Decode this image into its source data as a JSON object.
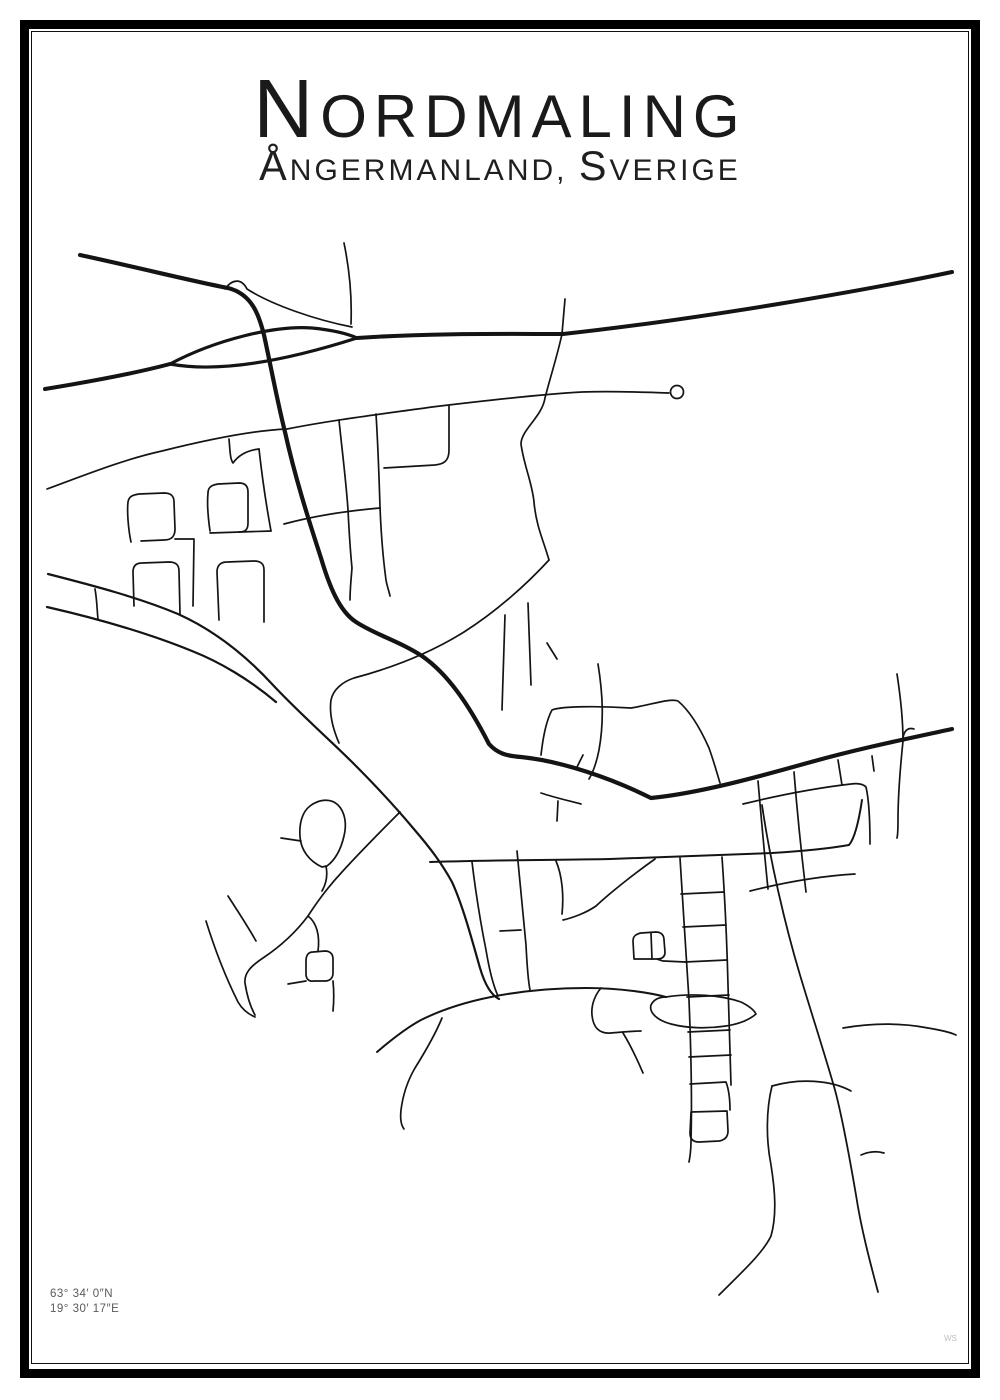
{
  "poster": {
    "title": "Nordmaling",
    "subtitle": "Ångermanland, Sverige",
    "coordinates": {
      "line1": "63° 34′ 0″N",
      "line2": "19° 30′ 17″E"
    },
    "watermark": "WS",
    "colors": {
      "road": "#141414",
      "frame": "#000000",
      "coord_text": "#5a5a5a"
    }
  },
  "map": {
    "viewBox": "0 0 1000 1400",
    "default_width": 1.7,
    "roads": [
      {
        "d": "M 45 389 C 100 380 140 372 170 364",
        "w": 4
      },
      {
        "d": "M 170 364 C 215 340 275 325 312 328 C 332 330 346 333 357 338",
        "w": 3.2
      },
      {
        "d": "M 170 364 C 218 373 285 361 357 338",
        "w": 3.2
      },
      {
        "d": "M 357 338 C 430 333 500 334 563 334 C 700 319 862 291 952 272",
        "w": 4
      },
      {
        "d": "M 80 255 C 140 268 196 282 228 288 C 252 294 259 315 264 335 C 271 367 277 400 285 432 C 295 477 308 518 321 558 C 329 585 339 611 356 622 C 376 635 399 641 422 656 C 448 674 469 705 489 744 C 497 753 506 756 521 757 C 561 761 611 778 651 798 C 701 793 761 776 811 762 C 861 748 911 738 952 729",
        "w": 4.2
      },
      {
        "d": "M 225 289 C 233 278 242 279 247 289 C 272 305 316 320 352 327"
      },
      {
        "d": "M 344 243 C 350 272 352 298 351 324"
      },
      {
        "d": "M 565 299 L 562 334"
      },
      {
        "d": "M 562 334 C 557 357 550 378 545 398 C 542 417 521 430 521 444 C 524 466 532 482 534 502 C 536 526 544 542 549 560"
      },
      {
        "d": "M 47 489 C 85 475 125 459 162 451 C 222 436 262 430 287 429 C 332 420 382 414 432 407 C 482 401 542 394 582 392 C 612 391 642 392 669 393"
      },
      {
        "d": "M 339 420 C 342 450 346 480 348 510 C 349 530 350 548 352 568 C 351 580 350 590 350 600"
      },
      {
        "d": "M 376 414 C 378 445 379 475 380 507 C 381 532 383 558 386 580 C 387 586 389 591 390 596"
      },
      {
        "d": "M 449 406 L 449 450 C 449 461 444 464 435 465 L 384 468"
      },
      {
        "d": "M 284 524 C 310 517 345 511 380 508"
      },
      {
        "d": "M 259 449 C 262 476 266 504 271 531"
      },
      {
        "d": "M 229 439 C 230 450 230 459 233 463 C 240 453 250 450 259 449"
      },
      {
        "d": "M 210 533 L 271 531"
      },
      {
        "d": "M 131 542 C 128 528 127 510 128 502 C 129 496 133 495 139 494 L 164 493 C 171 493 174 496 174 502 L 175 529 C 175 537 171 540 164 540 L 141 541"
      },
      {
        "d": "M 175 539 L 194 539 L 193 606"
      },
      {
        "d": "M 210 531 C 208 517 207 503 208 493 C 208 487 212 485 218 484 L 239 483 C 245 483 248 486 248 492 L 248 523 C 248 530 245 532 239 532"
      },
      {
        "d": "M 134 606 L 133 572 C 133 566 136 563 142 563 L 169 562 C 176 562 179 565 179 571 L 180 614"
      },
      {
        "d": "M 219 620 L 217 572 C 217 565 221 562 227 562 L 254 561 C 261 561 264 564 264 570 L 264 622"
      },
      {
        "d": "M 48 574 C 95 586 140 598 178 614 C 218 632 248 658 272 684 C 298 712 330 740 352 762 C 377 787 398 810 413 828 C 432 850 442 864 452 882 C 463 906 472 940 480 968 C 485 985 491 995 499 999",
        "w": 2.2
      },
      {
        "d": "M 47 607 C 95 618 148 633 192 651 C 220 662 250 680 276 702",
        "w": 2.2
      },
      {
        "d": "M 95 589 C 97 600 97 610 98 619"
      },
      {
        "d": "M 400 812 C 382 830 362 850 342 872 C 327 888 317 902 308 916 C 296 932 281 946 263 958 C 251 966 244 973 245 983 C 247 996 250 1006 255 1015"
      },
      {
        "d": "M 228 896 C 237 910 247 925 256 941"
      },
      {
        "d": "M 206 921 C 215 950 226 978 238 1002 C 242 1009 248 1014 255 1017"
      },
      {
        "d": "M 308 916 C 317 923 320 936 318 951"
      },
      {
        "d": "M 313 952 C 308 952 306 956 306 961 L 306 974 C 306 979 309 982 314 981 L 325 981 C 330 981 333 978 333 973 L 333 959 C 333 954 330 951 325 951 L 313 952"
      },
      {
        "d": "M 333 981 C 334 991 334 1001 333 1011"
      },
      {
        "d": "M 306 981 L 288 984"
      },
      {
        "d": "M 322 867 C 309 861 301 850 300 837 C 299 824 302 812 310 806 C 319 799 331 798 338 805 C 345 812 347 824 344 836 C 341 849 335 860 327 866 L 322 867"
      },
      {
        "d": "M 326 866 C 328 876 326 884 322 891"
      },
      {
        "d": "M 281 838 L 301 841"
      },
      {
        "d": "M 549 560 C 527 584 497 611 464 632 C 424 657 384 670 354 678 C 342 682 333 690 331 700 C 329 714 333 729 339 743"
      },
      {
        "d": "M 505 615 C 504 645 503 678 502 710"
      },
      {
        "d": "M 528 603 C 529 630 530 658 531 685"
      },
      {
        "d": "M 547 643 L 557 659"
      },
      {
        "d": "M 541 755 C 543 737 546 721 552 710 C 561 706 601 706 631 708 C 651 705 669 698 678 701 C 691 712 701 730 709 748 C 714 762 717 773 720 783"
      },
      {
        "d": "M 598 664 C 603 695 604 722 599 750 C 596 765 592 774 589 779"
      },
      {
        "d": "M 583 755 L 576 769"
      },
      {
        "d": "M 897 674 C 901 700 903 720 903 741 C 900 770 898 800 898 820 C 898 828 898 834 897 838"
      },
      {
        "d": "M 903 740 C 903 731 908 727 914 729"
      },
      {
        "d": "M 872 756 L 874 771"
      },
      {
        "d": "M 430 862 C 500 860 560 860 610 859 C 670 857 730 855 772 853 C 805 851 832 848 849 845 C 855 838 859 820 862 800",
        "w": 2
      },
      {
        "d": "M 556 861 C 562 875 564 895 562 914"
      },
      {
        "d": "M 655 859 C 638 871 612 891 596 906 C 586 913 572 918 563 920"
      },
      {
        "d": "M 680 858 C 683 905 686 955 689 1000 C 691 1050 692 1105 691 1140 C 691 1150 690 1157 689 1162"
      },
      {
        "d": "M 722 857 C 725 900 727 945 728 985 C 729 1020 730 1055 731 1085"
      },
      {
        "d": "M 681 894 L 724 892"
      },
      {
        "d": "M 683 927 L 726 925"
      },
      {
        "d": "M 685 962 L 727 960"
      },
      {
        "d": "M 687 997 L 729 995"
      },
      {
        "d": "M 688 1032 L 730 1030"
      },
      {
        "d": "M 689 1057 L 731 1055"
      },
      {
        "d": "M 690 1084 L 726 1082 C 729 1090 730 1100 730 1110"
      },
      {
        "d": "M 691 1112 L 727 1111 L 728 1131 C 728 1137 725 1140 719 1141 L 699 1142 C 693 1142 690 1139 690 1133 L 691 1112"
      },
      {
        "d": "M 762 805 C 770 860 785 925 800 975 C 812 1015 825 1055 835 1090 C 843 1120 850 1160 856 1195 C 861 1228 870 1262 878 1292",
        "w": 1.8
      },
      {
        "d": "M 861 1155 C 870 1151 877 1151 884 1153"
      },
      {
        "d": "M 772 1086 C 766 1110 766 1140 771 1165 C 775 1190 777 1215 771 1236 C 763 1253 741 1273 719 1295"
      },
      {
        "d": "M 772 1086 C 800 1078 831 1080 851 1091"
      },
      {
        "d": "M 843 1028 C 872 1023 902 1023 928 1028 C 940 1030 950 1032 956 1035"
      },
      {
        "d": "M 758 781 C 761 815 764 850 768 889"
      },
      {
        "d": "M 794 772 C 797 810 801 850 806 892"
      },
      {
        "d": "M 838 760 L 842 785"
      },
      {
        "d": "M 743 804 C 780 795 816 788 851 784 C 858 783 863 784 866 787 C 869 800 870 824 870 844"
      },
      {
        "d": "M 750 891 C 786 882 821 876 855 874"
      },
      {
        "d": "M 442 1018 C 435 1035 425 1052 415 1068 C 408 1080 403 1094 401 1110 C 400 1119 401 1125 404 1129"
      },
      {
        "d": "M 377 1052 C 391 1040 406 1028 421 1020 C 441 1010 466 1002 491 997 C 521 991 556 988 586 988 C 621 988 651 993 666 997",
        "w": 2
      },
      {
        "d": "M 666 997 C 691 993 721 995 741 1002 C 749 1006 754 1010 756 1014 C 749 1020 739 1024 726 1026 C 706 1029 686 1028 671 1024 C 656 1020 649 1012 651 1005 C 654 999 659 997 666 997"
      },
      {
        "d": "M 601 988 C 595 995 591 1005 592 1015 C 593 1027 599 1034 611 1033 C 623 1032 633 1031 641 1031"
      },
      {
        "d": "M 623 1033 C 631 1046 637 1059 643 1073"
      },
      {
        "d": "M 634 959 L 633 941 C 633 936 636 934 641 933 L 656 932 C 661 932 664 935 664 940 L 665 952 C 665 957 662 959 657 959 L 634 959"
      },
      {
        "d": "M 651 933 L 652 959"
      },
      {
        "d": "M 657 959 C 660 960 662 961 664 961 L 685 962"
      },
      {
        "d": "M 472 862 C 476 895 481 925 486 950 C 489 968 493 985 498 996"
      },
      {
        "d": "M 517 851 C 520 885 523 915 526 945 C 527 965 528 980 530 990"
      },
      {
        "d": "M 500 931 L 521 930"
      },
      {
        "d": "M 541 793 C 556 798 570 801 581 804"
      },
      {
        "d": "M 558 801 L 557 821"
      }
    ],
    "circles": [
      {
        "cx": 677,
        "cy": 392,
        "r": 6.5
      }
    ]
  }
}
